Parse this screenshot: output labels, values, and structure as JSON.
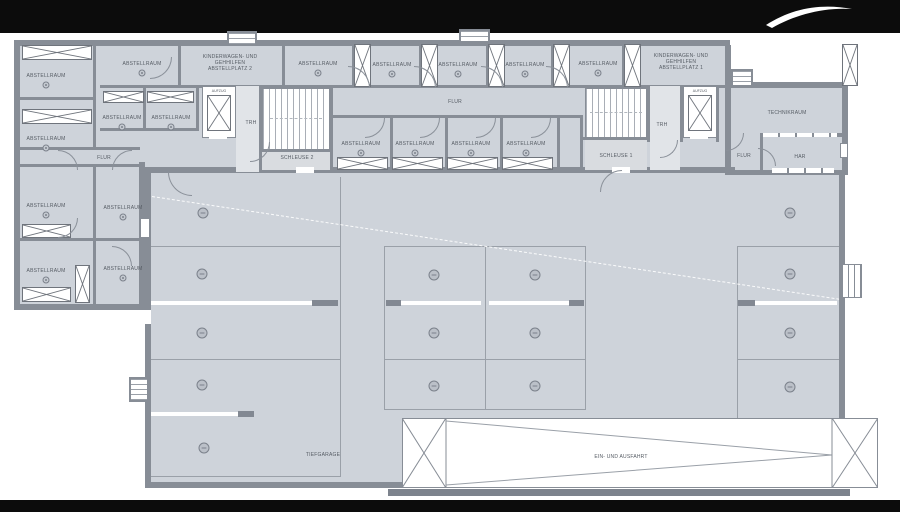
{
  "labels": {
    "abstellraum": "ABSTELLRAUM",
    "flur": "FLUR",
    "trh": "TRH",
    "aufzug": "AUFZUG",
    "schleuse1": "SCHLEUSE 1",
    "schleuse2": "SCHLEUSE 2",
    "technikraum": "TECHNIKRAUM",
    "har": "HAR",
    "tiefgarage": "TIEFGARAGE",
    "ein_und_ausfahrt": "EIN- UND AUSFAHRT",
    "kinderwagen2": {
      "l1": "KINDERWAGEN- UND",
      "l2": "GEHHILFEN",
      "l3": "ABSTELLPLATZ 2"
    },
    "kinderwagen1": {
      "l1": "KINDERWAGEN- UND",
      "l2": "GEHHILFEN",
      "l3": "ABSTELLPLATZ 1"
    }
  },
  "parking": {
    "marked_spaces": 15
  },
  "colors": {
    "room_fill": "#ced3da",
    "wall": "#878d96",
    "parking_line": "#9aa0a8",
    "text": "#565c64",
    "letterbox": "#0c0c0c"
  }
}
